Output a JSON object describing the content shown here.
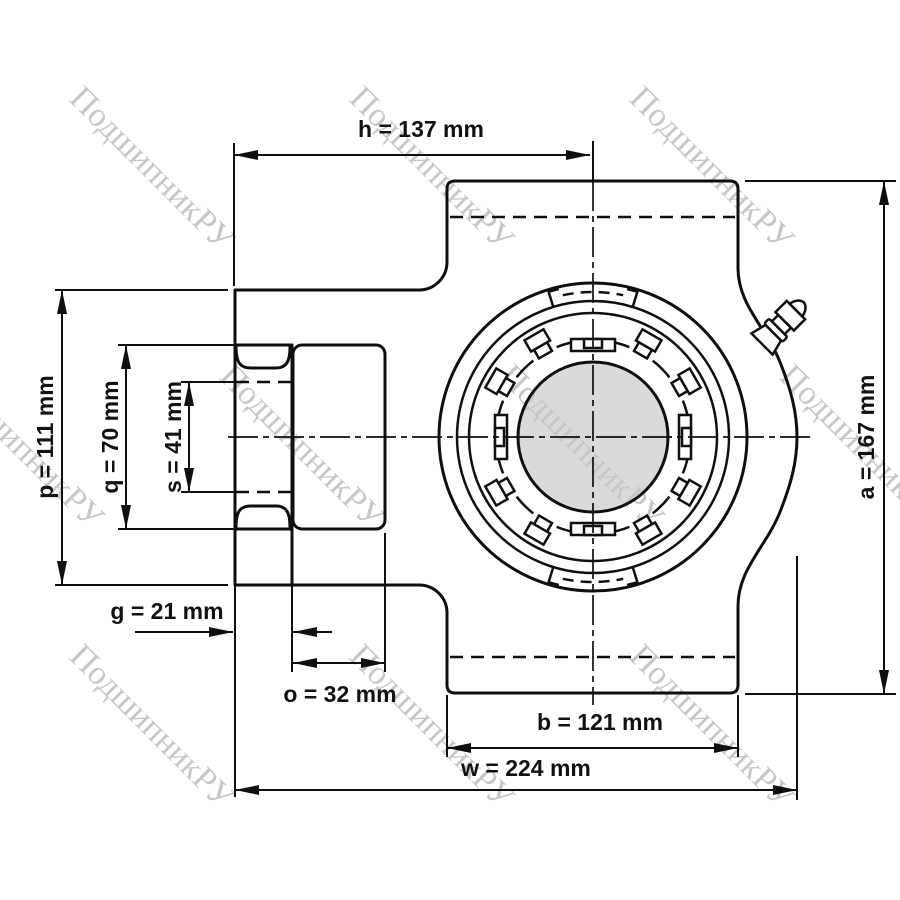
{
  "watermark": {
    "text": "ПодшипникРУ",
    "color": "#c7c7c7"
  },
  "drawing": {
    "subject": "take-up bearing unit, front view technical drawing",
    "line_color": "#0f0f0f",
    "shaft_fill": "#dadada"
  },
  "dimensions": {
    "h": {
      "label": "h = 137 mm",
      "value_mm": 137
    },
    "p": {
      "label": "p = 111 mm",
      "value_mm": 111
    },
    "q": {
      "label": "q = 70 mm",
      "value_mm": 70
    },
    "s": {
      "label": "s = 41 mm",
      "value_mm": 41
    },
    "a": {
      "label": "a = 167 mm",
      "value_mm": 167
    },
    "g": {
      "label": "g = 21 mm",
      "value_mm": 21
    },
    "o": {
      "label": "o = 32 mm",
      "value_mm": 32
    },
    "b": {
      "label": "b = 121 mm",
      "value_mm": 121
    },
    "w": {
      "label": "w = 224 mm",
      "value_mm": 224
    }
  }
}
